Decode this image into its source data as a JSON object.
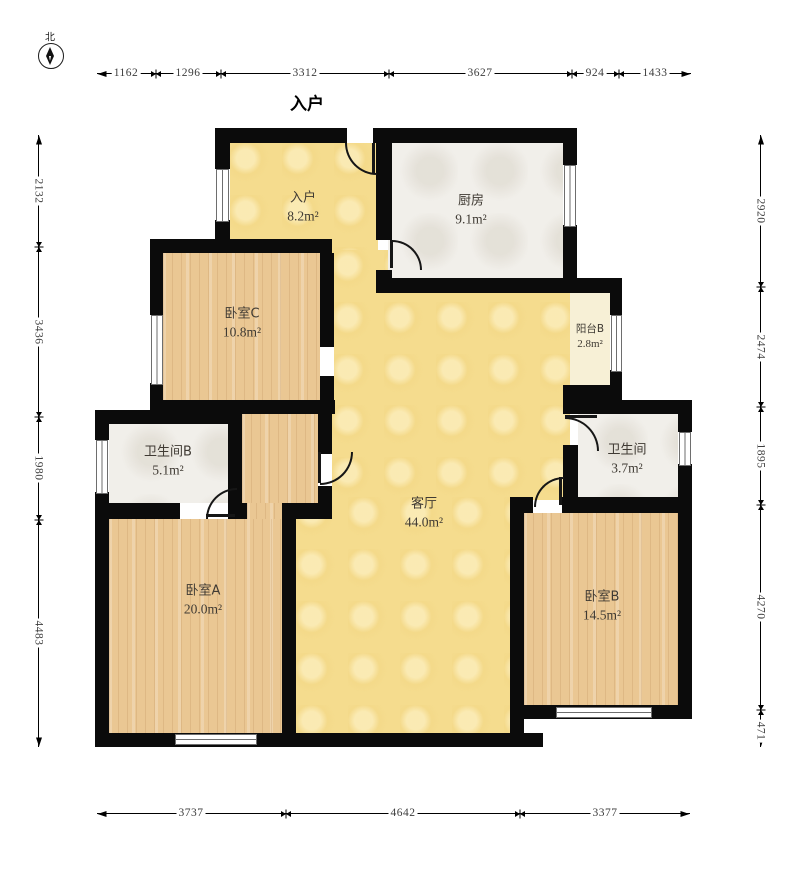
{
  "compass": {
    "north_label": "北"
  },
  "plan": {
    "entrance_label": "入户"
  },
  "rooms": [
    {
      "id": "entry",
      "name": "入户",
      "area": "8.2m²"
    },
    {
      "id": "kitchen",
      "name": "厨房",
      "area": "9.1m²"
    },
    {
      "id": "bedroom-c",
      "name": "卧室C",
      "area": "10.8m²"
    },
    {
      "id": "balcony-b",
      "name": "阳台B",
      "area": "2.8m²"
    },
    {
      "id": "bathroom-b",
      "name": "卫生间B",
      "area": "5.1m²"
    },
    {
      "id": "bathroom",
      "name": "卫生间",
      "area": "3.7m²"
    },
    {
      "id": "living",
      "name": "客厅",
      "area": "44.0m²"
    },
    {
      "id": "bedroom-a",
      "name": "卧室A",
      "area": "20.0m²"
    },
    {
      "id": "bedroom-b",
      "name": "卧室B",
      "area": "14.5m²"
    }
  ],
  "dimensions": {
    "top": [
      "1162",
      "1296",
      "3312",
      "3627",
      "924",
      "1433"
    ],
    "left": [
      "2132",
      "3436",
      "1980",
      "4483"
    ],
    "right": [
      "2920",
      "2474",
      "1895",
      "4270",
      "471"
    ],
    "bottom": [
      "3737",
      "4642",
      "3377"
    ]
  },
  "colors": {
    "wall": "#0b0b0b",
    "living_floor": "#f5dc8e",
    "wood_floor": "#eac793",
    "tile_floor": "#f1efea",
    "balcony_floor": "#f7f0d6"
  }
}
